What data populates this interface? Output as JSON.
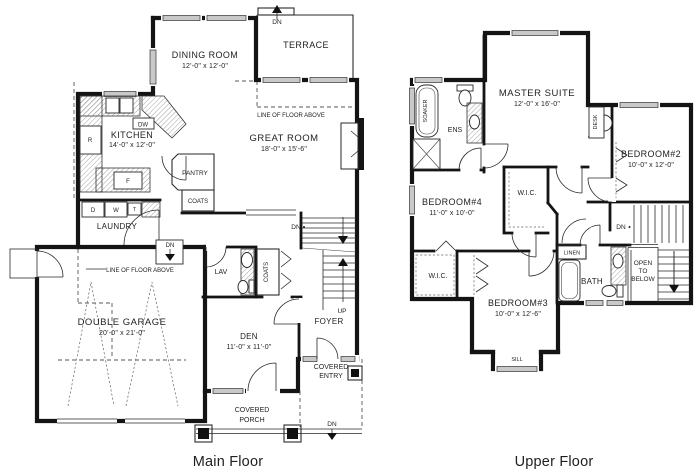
{
  "captions": {
    "main": "Main Floor",
    "upper": "Upper Floor"
  },
  "main_floor": {
    "dining": {
      "name": "DINING ROOM",
      "dims": "12'-0\" x 12'-0\""
    },
    "terrace": "TERRACE",
    "kitchen": {
      "name": "KITCHEN",
      "dims": "14'-0\" x 12'-0\""
    },
    "great_room": {
      "name": "GREAT ROOM",
      "dims": "18'-0\" x 15'-6\""
    },
    "garage": {
      "name": "DOUBLE GARAGE",
      "dims": "20'-0\" x 21'-0\""
    },
    "den": {
      "name": "DEN",
      "dims": "11'-0\" x 11'-0\""
    },
    "pantry": "PANTRY",
    "coats_hall": "COATS",
    "coats_foyer": "COATS",
    "laundry": "LAUNDRY",
    "lav": "LAV",
    "foyer": "FOYER",
    "up": "UP",
    "dn": "DN",
    "line_of_floor_above": "LINE OF FLOOR ABOVE",
    "covered_entry": [
      "COVERED",
      "ENTRY"
    ],
    "covered_porch": [
      "COVERED",
      "PORCH"
    ],
    "appliances": {
      "dw": "DW",
      "fridge": "R",
      "freezer": "F",
      "dryer": "D",
      "washer": "W",
      "laundry_tub": "T"
    }
  },
  "upper_floor": {
    "master": {
      "name": "MASTER SUITE",
      "dims": "12'-0\" x 16'-0\""
    },
    "bedroom2": {
      "name": "BEDROOM#2",
      "dims": "10'-0\" x 12'-0\""
    },
    "bedroom3": {
      "name": "BEDROOM#3",
      "dims": "10'-0\" x 12'-6\""
    },
    "bedroom4": {
      "name": "BEDROOM#4",
      "dims": "11'-0\" x 10'-0\""
    },
    "ens": "ENS",
    "soaker": "SOAKER",
    "desk": "DESK",
    "wic_hall": "W.I.C.",
    "wic_bedroom3": "W.I.C.",
    "linen": "LINEN",
    "bath": "BATH",
    "sill": "SILL",
    "open_to_below": [
      "OPEN",
      "TO",
      "BELOW"
    ],
    "dn": "DN"
  }
}
